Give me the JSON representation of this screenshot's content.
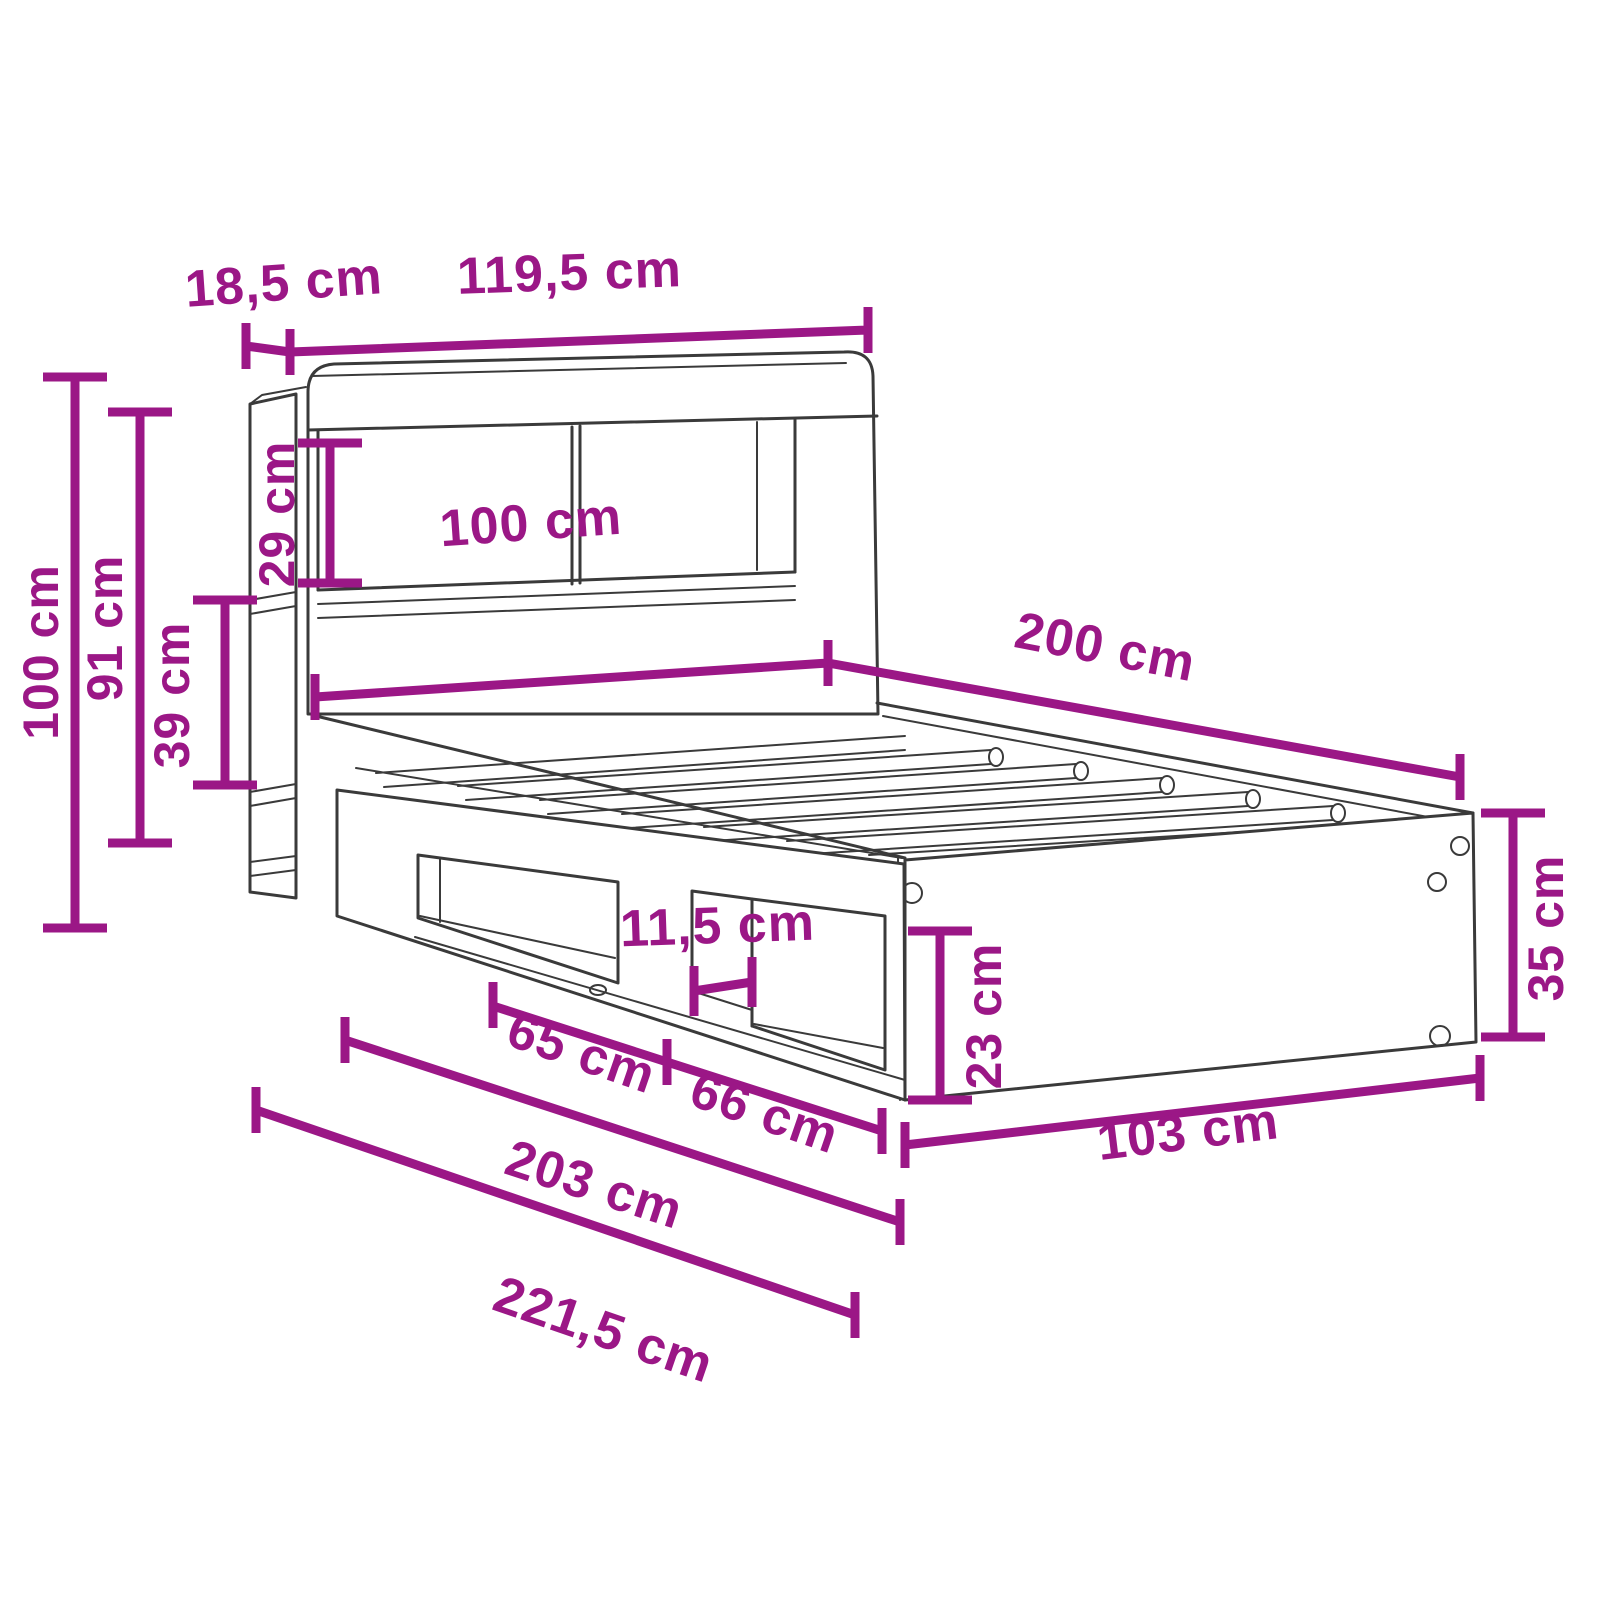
{
  "diagram": {
    "title": "Bed frame with bookcase headboard and storage cubbies - dimension drawing",
    "unit": "cm",
    "colors": {
      "dimension": "#9B1786",
      "outline": "#3A3A3A",
      "background": "#FFFFFF"
    },
    "dimensions": {
      "headboard_depth": {
        "label": "18,5 cm",
        "value": 18.5
      },
      "headboard_width": {
        "label": "119,5 cm",
        "value": 119.5
      },
      "total_height": {
        "label": "100 cm",
        "value": 100
      },
      "headboard_panel_height": {
        "label": "91 cm",
        "value": 91
      },
      "side_shelf_spacing": {
        "label": "39 cm",
        "value": 39
      },
      "compartment_height": {
        "label": "29 cm",
        "value": 29
      },
      "bed_width": {
        "label": "100 cm",
        "value": 100
      },
      "bed_length": {
        "label": "200 cm",
        "value": 200
      },
      "divider_gap": {
        "label": "11,5 cm",
        "value": 11.5
      },
      "cubby_left_width": {
        "label": "65 cm",
        "value": 65
      },
      "cubby_right_width": {
        "label": "66 cm",
        "value": 66
      },
      "cubby_opening_height": {
        "label": "23 cm",
        "value": 23
      },
      "frame_height": {
        "label": "35 cm",
        "value": 35
      },
      "frame_outer_width": {
        "label": "103 cm",
        "value": 103
      },
      "frame_outer_length": {
        "label": "203 cm",
        "value": 203
      },
      "total_depth": {
        "label": "221,5 cm",
        "value": 221.5
      }
    }
  }
}
